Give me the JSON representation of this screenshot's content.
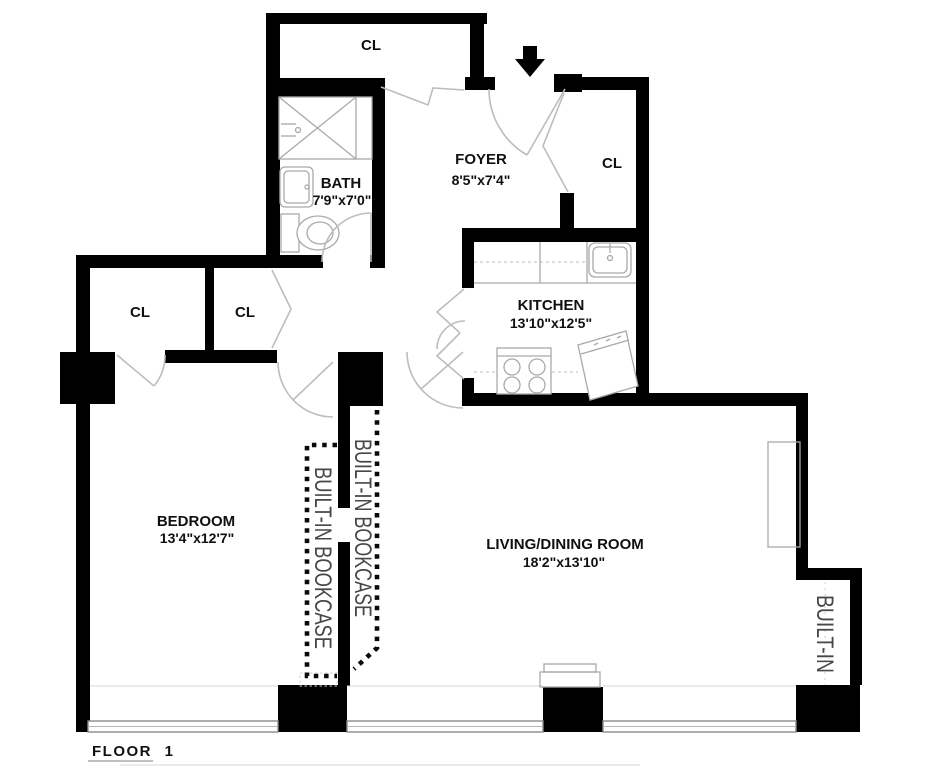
{
  "page": {
    "background": "#ffffff",
    "floor_label": "FLOOR 1"
  },
  "rooms": {
    "closet_top": {
      "label": "CL"
    },
    "bath": {
      "label": "BATH",
      "dims": "7'9\"x7'0\""
    },
    "foyer": {
      "label": "FOYER",
      "dims": "8'5\"x7'4\""
    },
    "closet_foyer": {
      "label": "CL"
    },
    "kitchen": {
      "label": "KITCHEN",
      "dims": "13'10\"x12'5\""
    },
    "closet_hall_left": {
      "label": "CL"
    },
    "closet_hall_right": {
      "label": "CL"
    },
    "bedroom": {
      "label": "BEDROOM",
      "dims": "13'4\"x12'7\""
    },
    "living_dining": {
      "label": "LIVING/DINING ROOM",
      "dims": "18'2\"x13'10\""
    }
  },
  "built_ins": {
    "bookcase_bedroom_label": "BUILT-IN BOOKCASE",
    "bookcase_living_label": "BUILT-IN BOOKCASE",
    "niche_label": "BUILT-IN"
  },
  "icons": {
    "entry_arrow": "entry-direction-down-arrow"
  },
  "colors": {
    "wall": "#000000",
    "fixture_line": "#a9a9a9",
    "door_line": "#bdbdbd",
    "bookcase_dash": "#0a0a0a",
    "label_text": "#101010",
    "builtin_text": "#474747"
  }
}
